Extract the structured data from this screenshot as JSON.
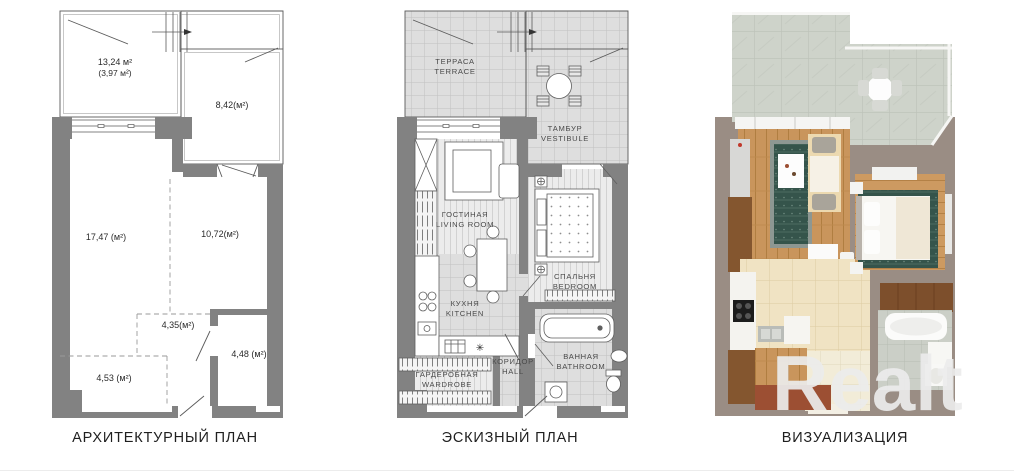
{
  "captions": {
    "architectural": "АРХИТЕКТУРНЫЙ ПЛАН",
    "sketch": "ЭСКИЗНЫЙ ПЛАН",
    "visualization": "ВИЗУАЛИЗАЦИЯ"
  },
  "watermark": "Realt",
  "architectural_plan": {
    "areas": {
      "terrace_total": "13,24 м²",
      "terrace_reduced": "(3,97 м²)",
      "vestibule": "8,42(м²)",
      "living_room": "17,47 (м²)",
      "bedroom": "10,72(м²)",
      "hall": "4,35(м²)",
      "bathroom": "4,48 (м²)",
      "wardrobe": "4,53 (м²)"
    }
  },
  "sketch_plan": {
    "rooms": {
      "terrace": {
        "ru": "ТЕРРАСА",
        "en": "TERRACE"
      },
      "vestibule": {
        "ru": "ТАМБУР",
        "en": "VESTIBULE"
      },
      "living": {
        "ru": "ГОСТИНАЯ",
        "en": "LIVING ROOM"
      },
      "bedroom": {
        "ru": "СПАЛЬНЯ",
        "en": "BEDROOM"
      },
      "kitchen": {
        "ru": "КУХНЯ",
        "en": "KITCHEN"
      },
      "wardrobe": {
        "ru": "ГАРДЕРОБНАЯ",
        "en": "WARDROBE"
      },
      "hall": {
        "ru": "КОРИДОР",
        "en": "HALL"
      },
      "bathroom": {
        "ru": "ВАННАЯ",
        "en": "BATHROOM"
      }
    },
    "kitchen_symbol": "✳"
  },
  "colors": {
    "wall_gray": "#828282",
    "wall_3d_taupe": "#9a8d84",
    "wood_floor": "#c9955c",
    "terrace_marble": "#ced3ca",
    "kitchen_tile": "#f0e3c3",
    "bath_tile": "#cbcfc7",
    "rug_teal": "#35544b",
    "cabinet_brown": "#84562f",
    "accent_brown": "#9c4f33",
    "watermark_gray": "#ececec"
  }
}
